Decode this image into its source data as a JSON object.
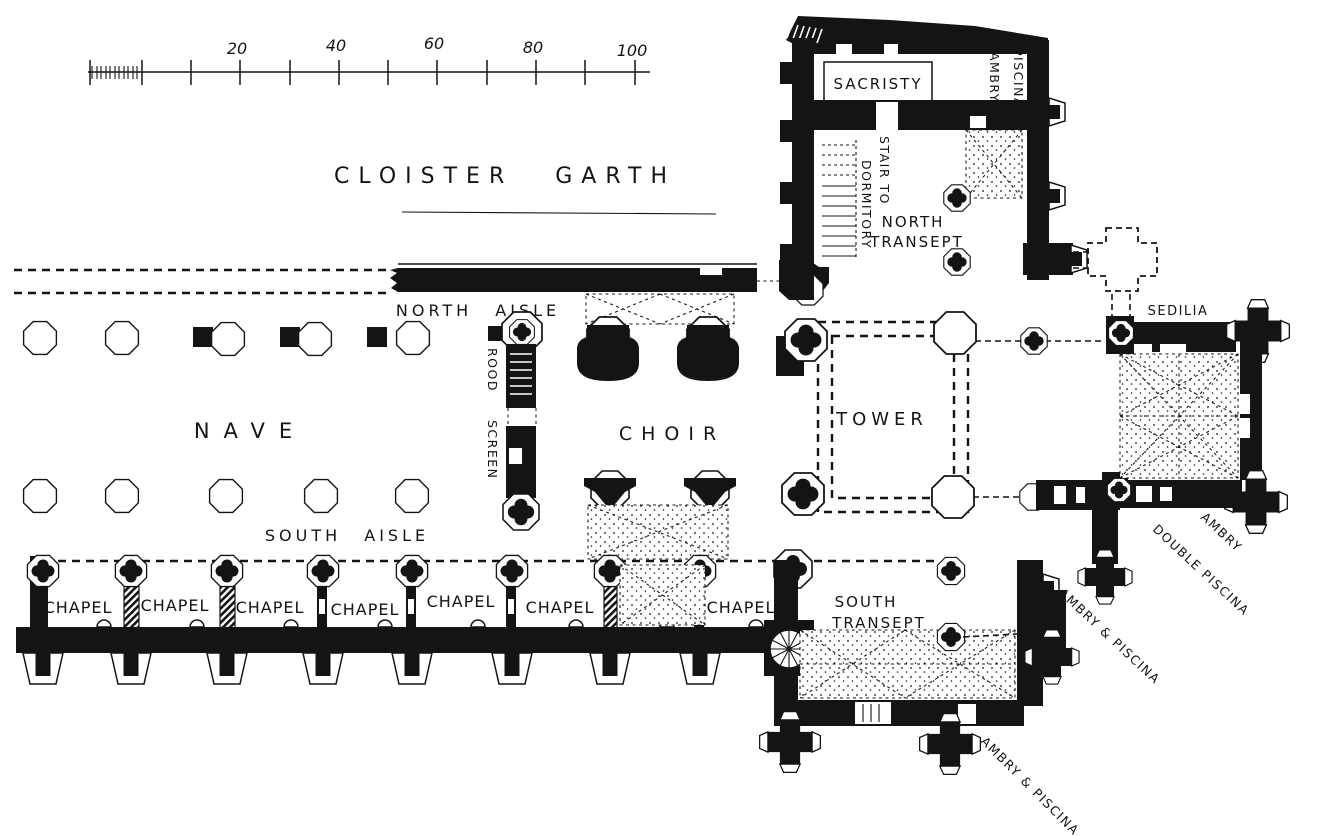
{
  "figure": {
    "kind": "architectural-floor-plan",
    "subject": "Ground plan of a monastic church",
    "ink_color": "#141414",
    "background_color": "#ffffff"
  },
  "scale_bar": {
    "tick_labels": [
      "20",
      "40",
      "60",
      "80",
      "100"
    ]
  },
  "labels": {
    "cloister_garth": "CLOISTER GARTH",
    "sacristy": "SACRISTY",
    "ambry_north": "AMBRY",
    "piscina_north": "PISCINA",
    "stair_to": "STAIR TO",
    "dormitory": "DORMITORY",
    "north_transept_line1": "NORTH",
    "north_transept_line2": "TRANSEPT",
    "north_aisle": "NORTH AISLE",
    "rood": "ROOD",
    "screen": "SCREEN",
    "nave": "NAVE",
    "choir": "CHOIR",
    "tower": "TOWER",
    "sedilia": "SEDILIA",
    "south_aisle": "SOUTH AISLE",
    "south_transept_line1": "SOUTH",
    "south_transept_line2": "TRANSEPT",
    "ambry_east": "AMBRY",
    "double_piscina": "DOUBLE PISCINA",
    "ambry_piscina_southeast": "AMBRY & PISCINA",
    "ambry_piscina_south": "AMBRY & PISCINA",
    "chapels": [
      "CHAPEL",
      "CHAPEL",
      "CHAPEL",
      "CHAPEL",
      "CHAPEL",
      "CHAPEL",
      "CHAPEL"
    ]
  }
}
